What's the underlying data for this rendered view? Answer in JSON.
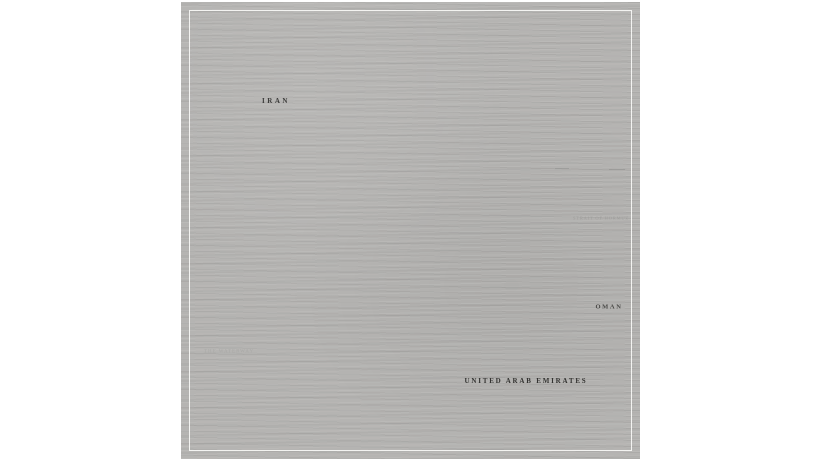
{
  "page": {
    "background": "#ffffff"
  },
  "artwork": {
    "type": "isometric-city-collage-map",
    "region_labels": {
      "iran": {
        "text": "IRAN"
      },
      "oman": {
        "text": "OMAN"
      },
      "uae": {
        "text": "UNITED ARAB EMIRATES"
      },
      "waterway": {
        "text": "THE WATERWAY"
      },
      "strait": {
        "text": "STRAIT OF HORMUZ"
      }
    },
    "colors": {
      "paper": "#b5b4b2",
      "sea": "#0c0c0c",
      "peninsula_light": "#a8a7a5",
      "peninsula_dark": "#949391",
      "grid_line": "#d7d7d5",
      "building_light_face": "#dcdcda",
      "building_light_side": "#a2a2a0",
      "building_light_top": "#f4f4f2",
      "building_dark_face": "#2c2c2a",
      "building_dark_side": "#141412",
      "building_dark_top": "#565654",
      "frame": "#f8f8f6"
    },
    "scene": {
      "grid": {
        "origin_x": 256,
        "origin_y": 108,
        "half_w": 26,
        "half_h": 15,
        "matrix": [
          [
            "ol",
            "ht",
            "dk",
            "dk",
            "dk",
            "dk",
            "dk",
            "dk"
          ],
          [
            "ol",
            "dk",
            "gv",
            "dk",
            "cl",
            "cl",
            "dk",
            "fl"
          ],
          [
            "em",
            "cd",
            "dk",
            "ht",
            "cl",
            "cl",
            "cl",
            "fl"
          ],
          [
            "cd",
            "dk",
            "cd",
            "cl",
            "cl",
            "dk",
            "cl",
            "dk"
          ],
          [
            "cd",
            "dk",
            "gv",
            "cd",
            "cl",
            "cl",
            "cl",
            "dk"
          ],
          [
            "ol",
            "cd",
            "dk",
            "ht",
            "cl",
            "cl",
            "dk",
            "dk"
          ],
          [
            "cd",
            "dk",
            "dk",
            "dk",
            "fg",
            "cl",
            "py",
            "dk"
          ],
          [
            "cd",
            "dk",
            "dk",
            "tw",
            "fg",
            "dk",
            "tw",
            "dk"
          ]
        ],
        "extra_tiles": [
          {
            "c": 4,
            "r": 8,
            "t": "tw"
          },
          {
            "c": 5,
            "r": 8,
            "t": "fg"
          },
          {
            "c": 6,
            "r": 8,
            "t": "fg"
          },
          {
            "c": 5,
            "r": 9,
            "t": "dk"
          },
          {
            "c": 7,
            "r": 8,
            "t": "dk"
          }
        ],
        "ghost_tiles": [
          [
            2,
            8
          ],
          [
            3,
            8
          ],
          [
            3,
            9
          ],
          [
            4,
            9
          ],
          [
            4,
            10
          ],
          [
            5,
            10
          ],
          [
            6,
            10
          ],
          [
            7,
            10
          ],
          [
            6,
            11
          ],
          [
            7,
            11
          ],
          [
            7,
            9
          ],
          [
            8,
            9
          ],
          [
            8,
            10
          ],
          [
            8,
            8
          ],
          [
            9,
            9
          ],
          [
            9,
            10
          ],
          [
            5,
            11
          ]
        ]
      },
      "sea_polygon": [
        [
          0,
          236
        ],
        [
          55,
          248
        ],
        [
          110,
          262
        ],
        [
          155,
          278
        ],
        [
          185,
          290
        ],
        [
          215,
          303
        ],
        [
          245,
          273
        ],
        [
          262,
          238
        ],
        [
          270,
          203
        ],
        [
          265,
          168
        ],
        [
          258,
          133
        ],
        [
          247,
          96
        ],
        [
          262,
          103
        ],
        [
          280,
          118
        ],
        [
          298,
          125
        ],
        [
          312,
          131
        ],
        [
          332,
          141
        ],
        [
          352,
          153
        ],
        [
          372,
          162
        ],
        [
          392,
          175
        ],
        [
          412,
          189
        ],
        [
          434,
          204
        ],
        [
          459,
          216
        ],
        [
          459,
          256
        ],
        [
          436,
          246
        ],
        [
          410,
          239
        ],
        [
          388,
          242
        ],
        [
          368,
          250
        ],
        [
          352,
          270
        ],
        [
          338,
          298
        ],
        [
          322,
          328
        ],
        [
          306,
          353
        ],
        [
          288,
          376
        ],
        [
          268,
          392
        ],
        [
          253,
          400
        ],
        [
          260,
          426
        ],
        [
          256,
          459
        ],
        [
          0,
          459
        ]
      ],
      "peninsula_polygon": [
        [
          368,
          250
        ],
        [
          388,
          242
        ],
        [
          410,
          239
        ],
        [
          436,
          246
        ],
        [
          459,
          256
        ],
        [
          459,
          459
        ],
        [
          256,
          459
        ],
        [
          260,
          426
        ],
        [
          253,
          400
        ],
        [
          268,
          392
        ],
        [
          288,
          376
        ],
        [
          306,
          353
        ],
        [
          322,
          328
        ],
        [
          338,
          298
        ],
        [
          352,
          270
        ]
      ],
      "iran_hatch_patch": [
        [
          64,
          40
        ],
        [
          112,
          50
        ],
        [
          92,
          78
        ],
        [
          44,
          66
        ]
      ],
      "islands": [
        {
          "x": 57,
          "y": 281,
          "rx": 14,
          "ry": 9,
          "big": true
        },
        {
          "x": 71,
          "y": 320,
          "rx": 6,
          "ry": 3.5
        },
        {
          "x": 92,
          "y": 331,
          "rx": 4,
          "ry": 2.5
        },
        {
          "x": 116,
          "y": 337,
          "rx": 5,
          "ry": 3
        },
        {
          "x": 151,
          "y": 413,
          "rx": 6,
          "ry": 3.5
        }
      ],
      "clouds": [
        {
          "x": 249,
          "y": 101,
          "rx": 9,
          "ry": 5
        },
        {
          "x": 259,
          "y": 107,
          "rx": 6,
          "ry": 3.5
        }
      ],
      "antenna": {
        "x": 337,
        "y_top": 108,
        "y_base": 148
      },
      "eiffel_tower": {
        "x": 167,
        "y_base": 153,
        "y_top": 121
      },
      "arcs": [
        {
          "cx": 448,
          "cy": 332,
          "r": 88
        },
        {
          "cx": 448,
          "cy": 332,
          "r": 116
        }
      ]
    }
  }
}
